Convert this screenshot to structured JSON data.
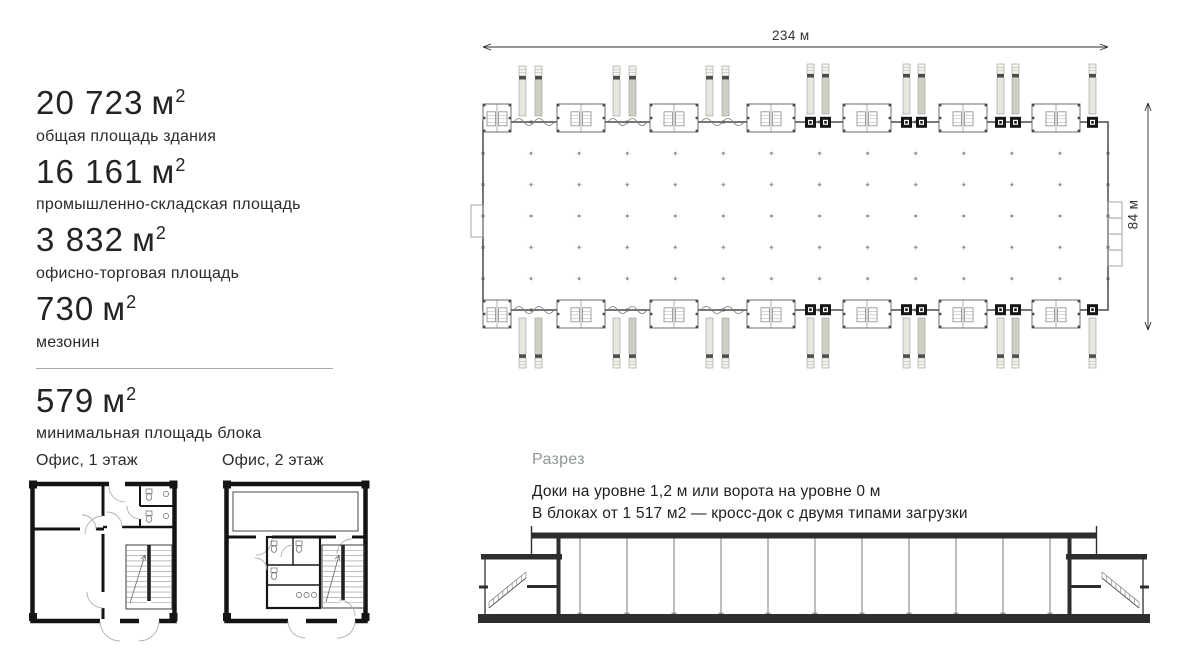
{
  "stats": {
    "items": [
      {
        "value": "20 723",
        "unit": "м",
        "sup": "2",
        "label": "общая площадь здания"
      },
      {
        "value": "16 161",
        "unit": "м",
        "sup": "2",
        "label": "промышленно-складская площадь"
      },
      {
        "value": "3 832",
        "unit": "м",
        "sup": "2",
        "label": "офисно-торговая площадь"
      },
      {
        "value": "730",
        "unit": "м",
        "sup": "2",
        "label": "мезонин"
      },
      {
        "value": "579",
        "unit": "м",
        "sup": "2",
        "label": "минимальная площадь блока"
      }
    ]
  },
  "mini_plans": {
    "plan1_label": "Офис, 1 этаж",
    "plan2_label": "Офис, 2 этаж"
  },
  "site_plan": {
    "width_dim": "234 м",
    "height_dim": "84 м"
  },
  "section": {
    "title": "Разрез",
    "line1": "Доки на уровне 1,2 м или ворота на уровне 0 м",
    "line2": "В блоках от 1 517 м2 — кросс-док с двумя типами загрузки"
  },
  "colors": {
    "text": "#1d1d1d",
    "muted_title": "#8f9797",
    "drawing_dark": "#2e2e2e",
    "truck_gray": "#cfcfc4",
    "truck_light": "#e7e7e0"
  }
}
